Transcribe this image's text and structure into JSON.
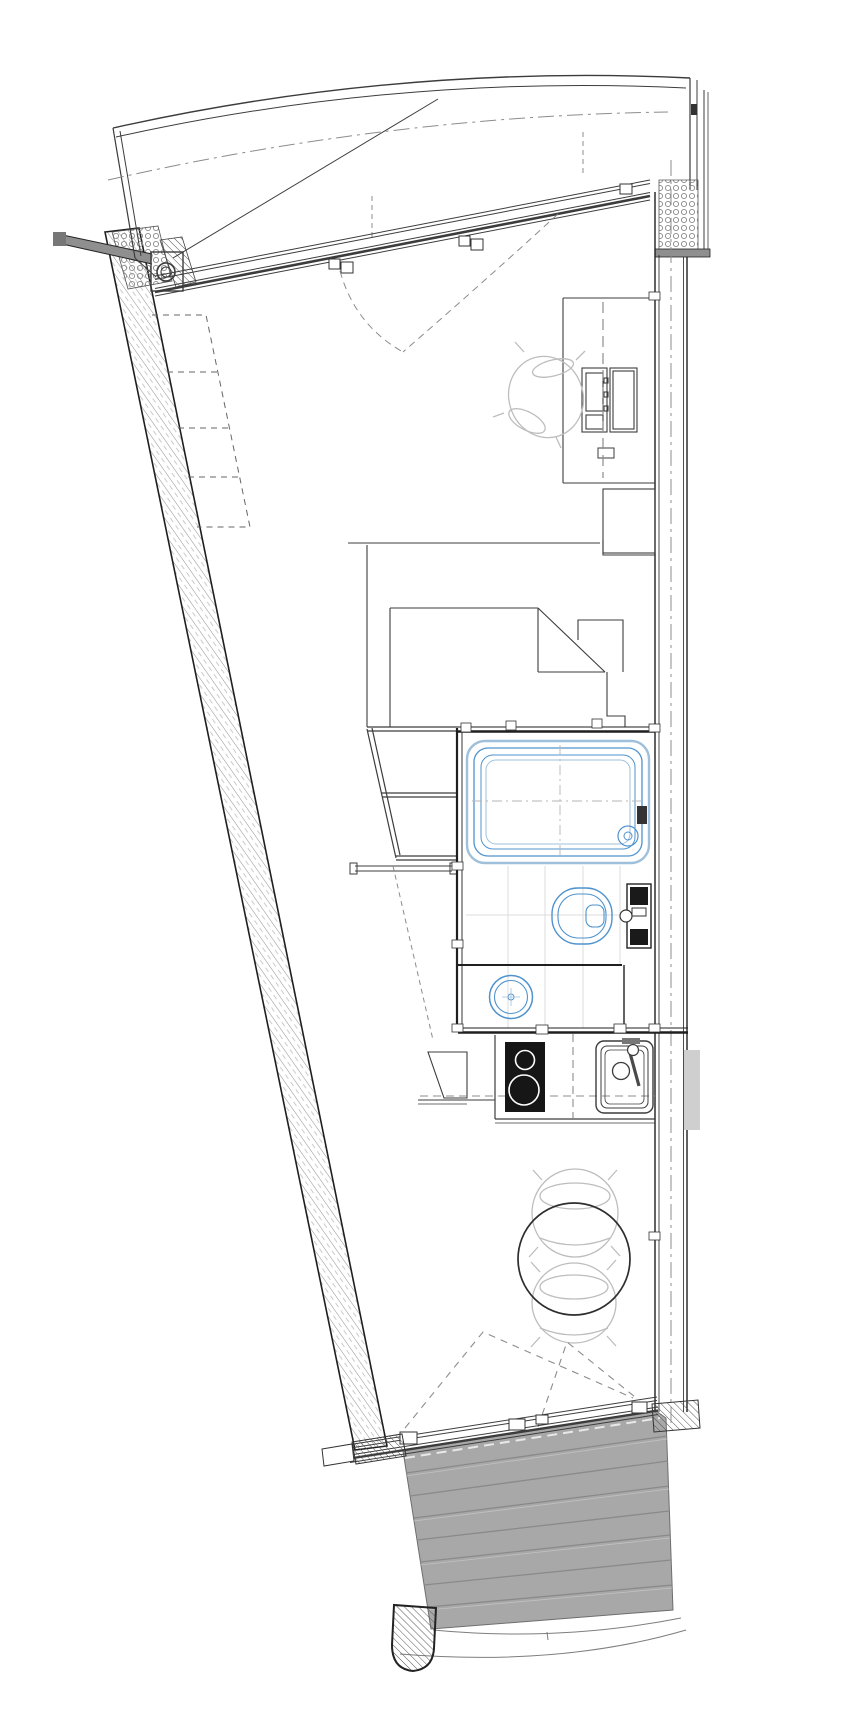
{
  "plan": {
    "kind": "architectural-floor-plan",
    "description": "wedge-shaped studio apartment: balcony top, living space, bathroom core with bathtub wc basin, kitchenette, dining table, entry doors to terrace steps",
    "colors": {
      "line": "#3c3c3c",
      "wall": "#1f1f1f",
      "light": "#bdbdbd",
      "fixture_blue": "#4f93ce",
      "fixture_blue_soft": "#9fc0da",
      "tile": "#dcdcdc",
      "dash": "#8c8c8c",
      "steps_fill": "#a8a8a8",
      "steps_line": "#8a8a8a",
      "steps_edge": "#6e6e6e",
      "cooktop": "#161616",
      "cap_gray": "#8f8f8f",
      "neighbor_gray": "#cfcfcf"
    },
    "rooms": {
      "balcony": "balcony",
      "main_room": "living-space",
      "bathroom": "bathroom",
      "kitchen": "kitchenette",
      "entry": "entry-terrace-steps"
    },
    "fixtures": [
      "bathtub",
      "toilet",
      "wall-cistern",
      "round-washbasin",
      "cooktop",
      "kitchen-sink",
      "dining-table",
      "dining-chairs",
      "desk",
      "desk-chair",
      "bed",
      "wardrobe",
      "wall-shelf",
      "terrace-steps",
      "column"
    ]
  }
}
